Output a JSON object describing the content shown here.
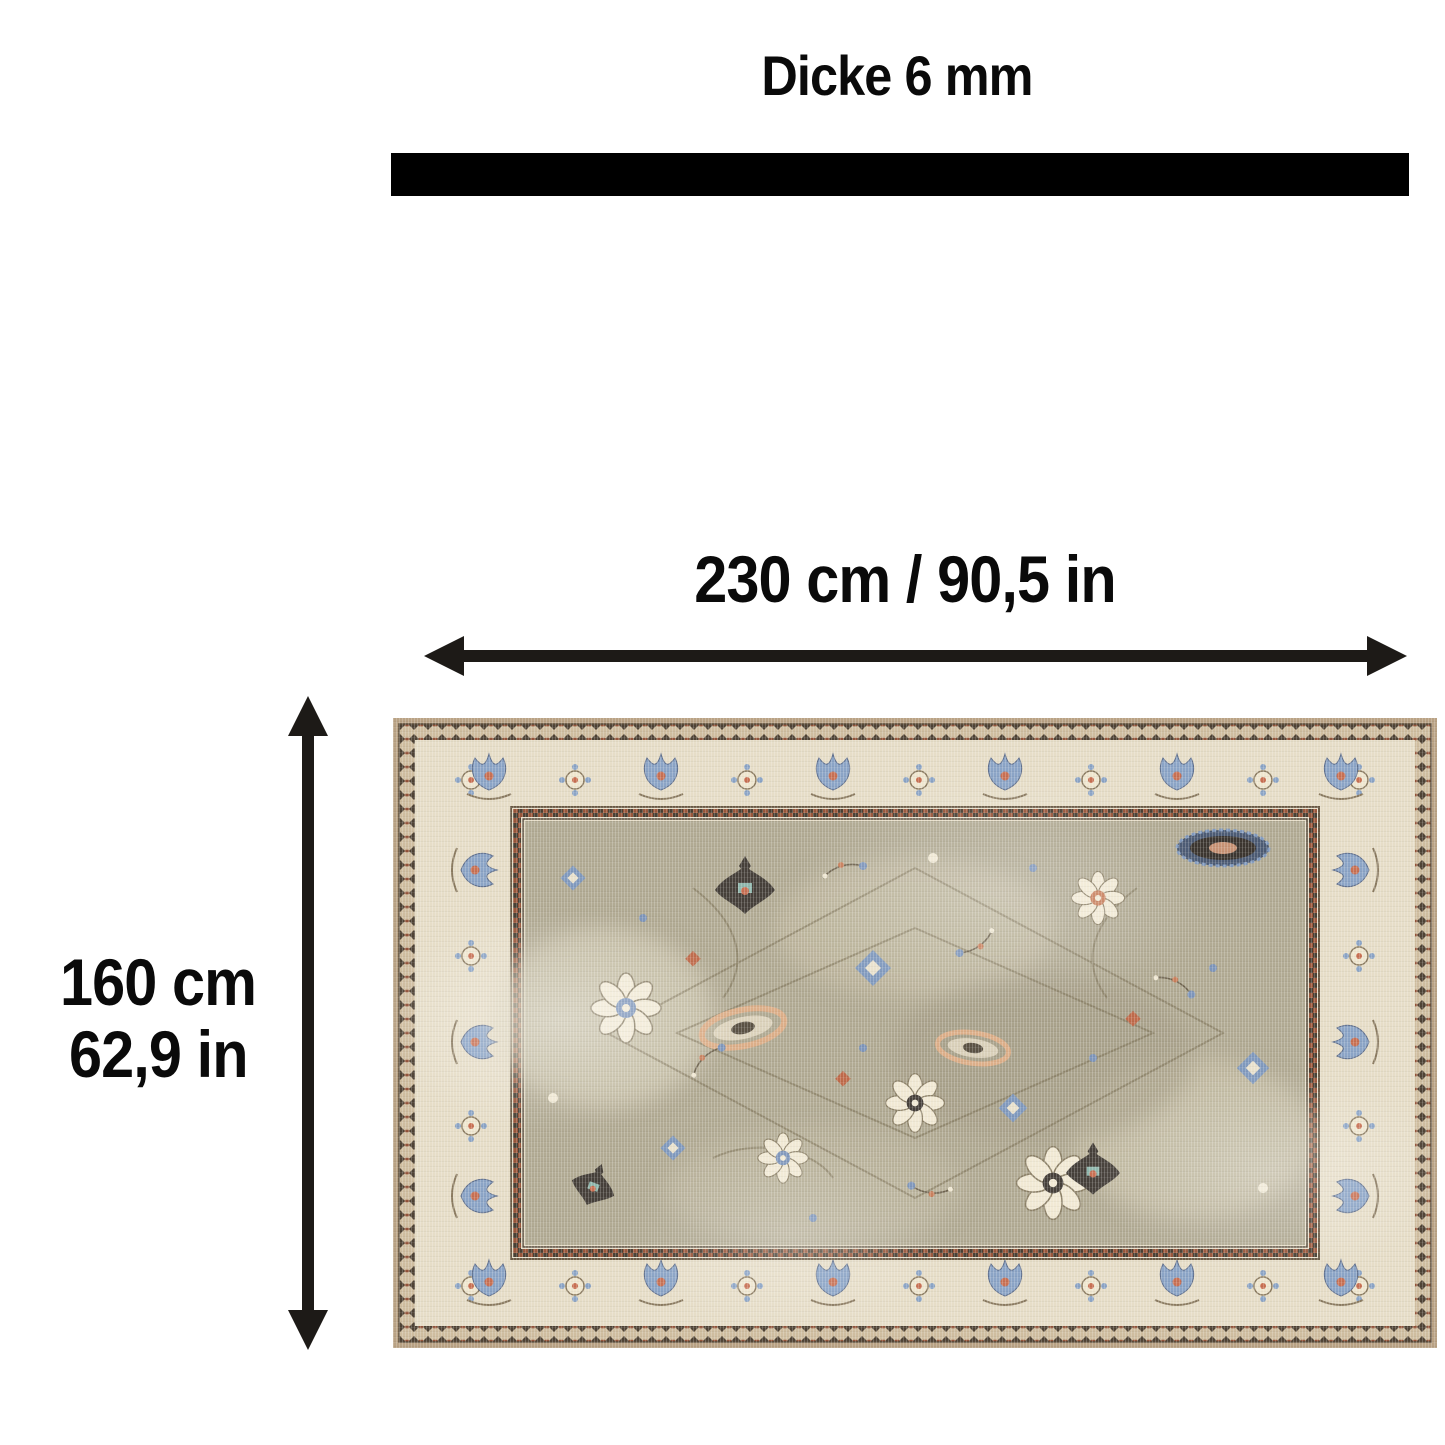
{
  "diagram": {
    "thickness": {
      "label": "Dicke 6 mm",
      "value_mm": 6,
      "bar_color": "#000000"
    },
    "width_dim": {
      "label": "230 cm / 90,5 in",
      "cm": 230,
      "inches": "90,5"
    },
    "height_dim": {
      "line1": "160 cm",
      "line2": "62,9 in",
      "cm": 160,
      "inches": "62,9"
    },
    "arrow_color": "#1d1a17",
    "rug": {
      "description": "vintage oriental rug, top view",
      "palette": {
        "edge_tan": "#b9a284",
        "outer_band": "#cfbd9f",
        "border_cream": "#e6ddc7",
        "field_taupe": "#b1aa93",
        "accent_blue": "#8099bd",
        "accent_rust": "#c87f5b",
        "accent_charcoal": "#46403a",
        "guard_red": "#99573b"
      }
    }
  }
}
